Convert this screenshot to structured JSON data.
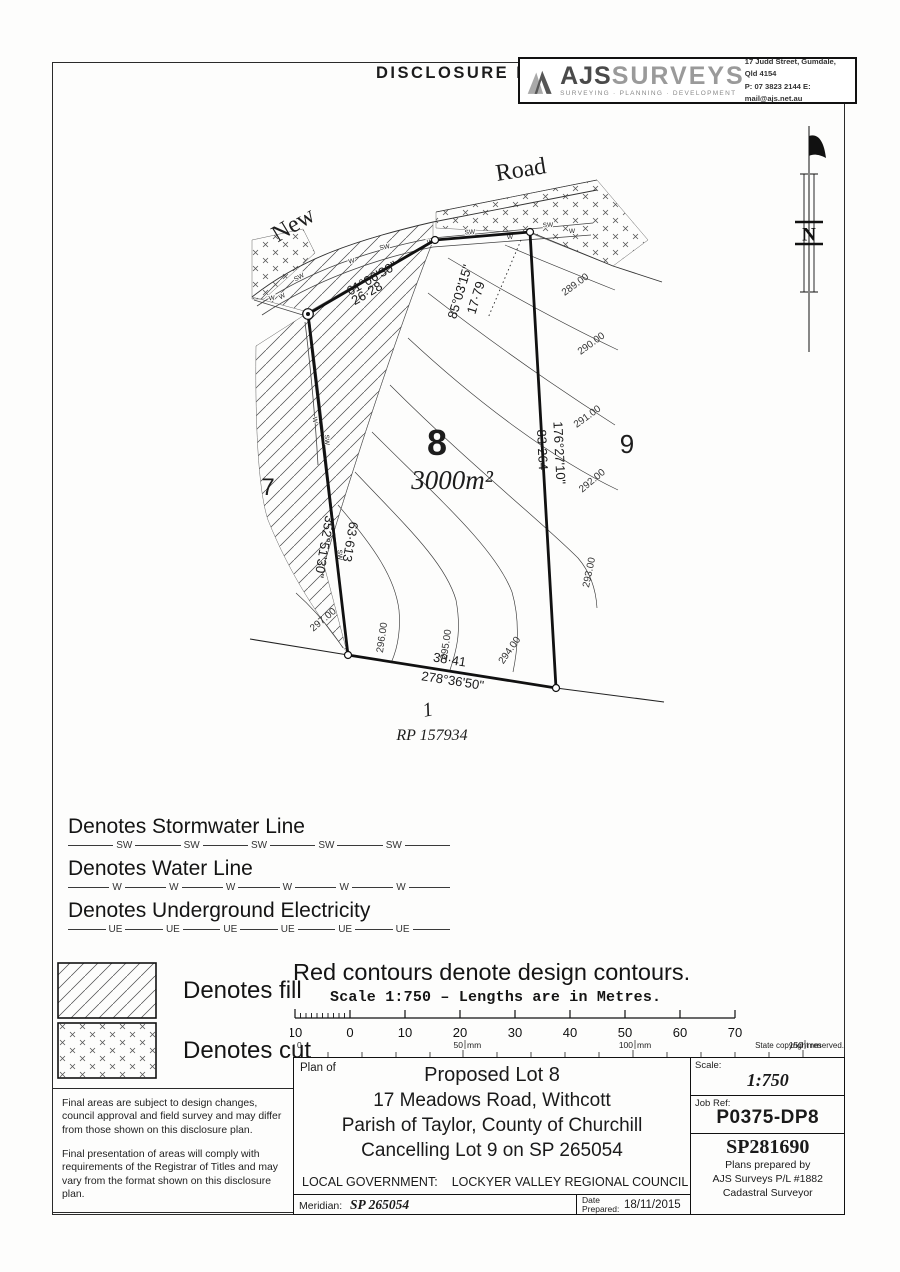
{
  "page": {
    "title": "DISCLOSURE PLAN"
  },
  "logo_box": {
    "name_bold": "AJS",
    "name_light": "SURVEYS",
    "tagline": "SURVEYING · PLANNING · DEVELOPMENT",
    "address": "17 Judd Street, Gumdale, Qld 4154",
    "contact": "P: 07 3823 2144  E: mail@ajs.net.au"
  },
  "north_arrow": {
    "label": "N"
  },
  "plan": {
    "road_name_1": "New",
    "road_name_2": "Road",
    "lot_main": {
      "number": "8",
      "area": "3000m²"
    },
    "lot_left": "7",
    "lot_right": "9",
    "lot_bottom": "1",
    "rp_label": "RP 157934",
    "bearings": {
      "top": {
        "bearing": "61°06'30\"",
        "distance": "26·28"
      },
      "top_right": {
        "bearing": "85°03'15\"",
        "distance": "17·79"
      },
      "right": {
        "bearing": "176°27'10\"",
        "distance": "83·264"
      },
      "left": {
        "bearing": "352°51'30\"",
        "distance": "63·613"
      },
      "bottom": {
        "bearing": "278°36'50\"",
        "distance": "38·41"
      }
    },
    "contours": [
      "289.00",
      "290.00",
      "291.00",
      "292.00",
      "293.00",
      "294.00",
      "295.00",
      "296.00",
      "297.00"
    ],
    "utility_sw": "SW",
    "utility_w": "W"
  },
  "legend": {
    "lines": [
      {
        "label": "Denotes Stormwater Line",
        "abbr": "SW"
      },
      {
        "label": "Denotes Water Line",
        "abbr": "W"
      },
      {
        "label": "Denotes Underground Electricity",
        "abbr": "UE"
      }
    ],
    "fill_label": "Denotes fill",
    "cut_label": "Denotes cut"
  },
  "notes": {
    "red_contours": "Red contours denote design contours.",
    "scale_line": "Scale 1:750  –  Lengths are in Metres."
  },
  "scale_bar": {
    "labels": [
      "10",
      "0",
      "10",
      "20",
      "30",
      "40",
      "50",
      "60",
      "70"
    ],
    "mm_labels": [
      "0",
      "50",
      "100",
      "150"
    ],
    "mm_unit": "mm",
    "copyright": "State copyright reserved."
  },
  "disclaimer": {
    "para1": "Final areas are subject to design changes, council approval and field survey and may differ from those shown on this disclosure plan.",
    "para2": "Final presentation of areas will comply with requirements of the Registrar of Titles and may vary from the format shown on this disclosure plan."
  },
  "title_block": {
    "plan_of": "Plan of",
    "line1": "Proposed Lot 8",
    "line2": "17 Meadows Road, Withcott",
    "line3": "Parish of Taylor, County of Churchill",
    "line4": "Cancelling Lot 9 on SP 265054",
    "local_gov_label": "LOCAL GOVERNMENT:",
    "local_gov_value": "LOCKYER VALLEY REGIONAL COUNCIL",
    "meridian_label": "Meridian:",
    "meridian_value": "SP 265054",
    "date_label": "Date\nPrepared:",
    "date_value": "18/11/2015",
    "scale_label": "Scale:",
    "scale_value": "1:750",
    "job_ref_label": "Job Ref:",
    "job_ref_value": "P0375-DP8",
    "sp_number": "SP281690",
    "prepared_by_1": "Plans prepared by",
    "prepared_by_2": "AJS Surveys P/L  #1882",
    "prepared_by_3": "Cadastral Surveyor"
  }
}
